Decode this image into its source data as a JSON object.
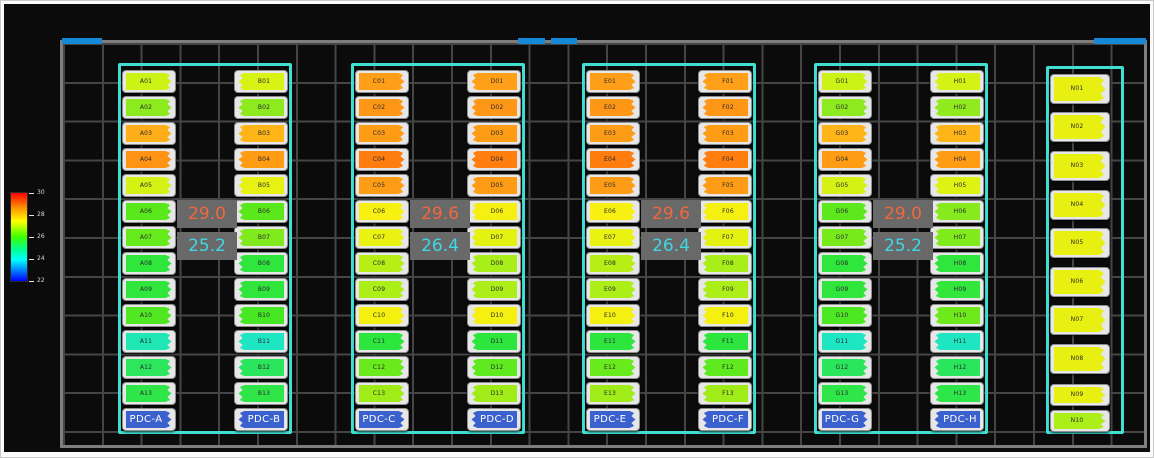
{
  "colors": {
    "canvas_bg": "#0b0b0b",
    "wall": "#7e7e7e",
    "grid_line": "#454545",
    "door_blue": "#1689d6",
    "containment_outline": "#40dfd2",
    "temp_box_bg": "#696969",
    "temp_hot_text": "#f2683c",
    "temp_cold_text": "#40d6e6",
    "pdc_fill": "#3a61ce",
    "rack_shell": "#e7e7e7"
  },
  "legend": {
    "ticks": [
      "30",
      "28",
      "26",
      "24",
      "22"
    ]
  },
  "doors": [
    {
      "x": 62,
      "w": 40
    },
    {
      "x": 518,
      "w": 27
    },
    {
      "x": 551,
      "w": 26
    },
    {
      "x": 1094,
      "w": 52
    }
  ],
  "groups": [
    {
      "x": 118,
      "temp_hot": "29.0",
      "temp_cold": "25.2",
      "columns": [
        {
          "facing": "right",
          "pdc": "PDC-A",
          "racks": [
            [
              "A01",
              "#ccf216"
            ],
            [
              "A02",
              "#8cea1e"
            ],
            [
              "A03",
              "#ffae1a"
            ],
            [
              "A04",
              "#ff9414"
            ],
            [
              "A05",
              "#d6f214"
            ],
            [
              "A06",
              "#58e81c"
            ],
            [
              "A07",
              "#66ea1c"
            ],
            [
              "A08",
              "#2ee63c"
            ],
            [
              "A09",
              "#30e63c"
            ],
            [
              "A10",
              "#50e822"
            ],
            [
              "A11",
              "#20e6b4"
            ],
            [
              "A12",
              "#2ce65e"
            ],
            [
              "A13",
              "#2ee648"
            ]
          ]
        },
        {
          "facing": "left",
          "pdc": "PDC-B",
          "racks": [
            [
              "B01",
              "#d8f214"
            ],
            [
              "B02",
              "#8cea1e"
            ],
            [
              "B03",
              "#ffb418"
            ],
            [
              "B04",
              "#ff9c14"
            ],
            [
              "B05",
              "#e8f212"
            ],
            [
              "B06",
              "#5ae81c"
            ],
            [
              "B07",
              "#80ea1c"
            ],
            [
              "B08",
              "#2ee63c"
            ],
            [
              "B09",
              "#30e63c"
            ],
            [
              "B10",
              "#46e824"
            ],
            [
              "B11",
              "#1ee6c2"
            ],
            [
              "B12",
              "#2ae65c"
            ],
            [
              "B13",
              "#2ee648"
            ]
          ]
        }
      ]
    },
    {
      "x": 351,
      "temp_hot": "29.6",
      "temp_cold": "26.4",
      "columns": [
        {
          "facing": "right",
          "pdc": "PDC-C",
          "racks": [
            [
              "C01",
              "#ff9e18"
            ],
            [
              "C02",
              "#ff9616"
            ],
            [
              "C03",
              "#ff9c16"
            ],
            [
              "C04",
              "#ff7c0e"
            ],
            [
              "C05",
              "#ff9c16"
            ],
            [
              "C06",
              "#f8f010"
            ],
            [
              "C07",
              "#eaf212"
            ],
            [
              "C08",
              "#b6ee16"
            ],
            [
              "C09",
              "#acee18"
            ],
            [
              "C10",
              "#f4f010"
            ],
            [
              "C11",
              "#2ce63e"
            ],
            [
              "C12",
              "#68ea1c"
            ],
            [
              "C13",
              "#a0ec18"
            ]
          ]
        },
        {
          "facing": "left",
          "pdc": "PDC-D",
          "racks": [
            [
              "D01",
              "#ffa018"
            ],
            [
              "D02",
              "#ff9616"
            ],
            [
              "D03",
              "#ff9c16"
            ],
            [
              "D04",
              "#ff7e0e"
            ],
            [
              "D05",
              "#ff9c16"
            ],
            [
              "D06",
              "#f6f010"
            ],
            [
              "D07",
              "#e4f212"
            ],
            [
              "D08",
              "#a8ee18"
            ],
            [
              "D09",
              "#acee18"
            ],
            [
              "D10",
              "#f4f010"
            ],
            [
              "D11",
              "#2ce63e"
            ],
            [
              "D12",
              "#5eea1e"
            ],
            [
              "D13",
              "#a0ec18"
            ]
          ]
        }
      ]
    },
    {
      "x": 582,
      "temp_hot": "29.6",
      "temp_cold": "26.4",
      "columns": [
        {
          "facing": "right",
          "pdc": "PDC-E",
          "racks": [
            [
              "E01",
              "#ff9e18"
            ],
            [
              "E02",
              "#ff9616"
            ],
            [
              "E03",
              "#ff9c16"
            ],
            [
              "E04",
              "#ff7c0e"
            ],
            [
              "E05",
              "#ff9c16"
            ],
            [
              "E06",
              "#f8f010"
            ],
            [
              "E07",
              "#eaf212"
            ],
            [
              "E08",
              "#b6ee16"
            ],
            [
              "E09",
              "#acee18"
            ],
            [
              "E10",
              "#f4f010"
            ],
            [
              "E11",
              "#2ce63e"
            ],
            [
              "E12",
              "#68ea1c"
            ],
            [
              "E13",
              "#a0ec18"
            ]
          ]
        },
        {
          "facing": "left",
          "pdc": "PDC-F",
          "racks": [
            [
              "F01",
              "#ffa018"
            ],
            [
              "F02",
              "#ff9616"
            ],
            [
              "F03",
              "#ff9c16"
            ],
            [
              "F04",
              "#ff7e0e"
            ],
            [
              "F05",
              "#ff9c16"
            ],
            [
              "F06",
              "#f6f010"
            ],
            [
              "F07",
              "#e4f212"
            ],
            [
              "F08",
              "#a8ee18"
            ],
            [
              "F09",
              "#acee18"
            ],
            [
              "F10",
              "#f4f010"
            ],
            [
              "F11",
              "#2ce63e"
            ],
            [
              "F12",
              "#5eea1e"
            ],
            [
              "F13",
              "#a0ec18"
            ]
          ]
        }
      ]
    },
    {
      "x": 814,
      "temp_hot": "29.0",
      "temp_cold": "25.2",
      "columns": [
        {
          "facing": "right",
          "pdc": "PDC-G",
          "racks": [
            [
              "G01",
              "#ccf216"
            ],
            [
              "G02",
              "#8cea1e"
            ],
            [
              "G03",
              "#ffb418"
            ],
            [
              "G04",
              "#ff9c14"
            ],
            [
              "G05",
              "#d6f214"
            ],
            [
              "G06",
              "#5ce81c"
            ],
            [
              "G07",
              "#78ea1c"
            ],
            [
              "G08",
              "#2ee63c"
            ],
            [
              "G09",
              "#30e63c"
            ],
            [
              "G10",
              "#4ce822"
            ],
            [
              "G11",
              "#1ee6c2"
            ],
            [
              "G12",
              "#2ae65c"
            ],
            [
              "G13",
              "#2ee648"
            ]
          ]
        },
        {
          "facing": "left",
          "pdc": "PDC-H",
          "racks": [
            [
              "H01",
              "#d4f214"
            ],
            [
              "H02",
              "#90ea1e"
            ],
            [
              "H03",
              "#ffb418"
            ],
            [
              "H04",
              "#ff9c14"
            ],
            [
              "H05",
              "#def213"
            ],
            [
              "H06",
              "#86ea1c"
            ],
            [
              "H07",
              "#80ea1c"
            ],
            [
              "H08",
              "#2ee63c"
            ],
            [
              "H09",
              "#32e63c"
            ],
            [
              "H10",
              "#6eea1c"
            ],
            [
              "H11",
              "#1ee6c2"
            ],
            [
              "H12",
              "#2ae65c"
            ],
            [
              "H13",
              "#2ee648"
            ]
          ]
        }
      ]
    }
  ],
  "n_column": {
    "x": 1046,
    "shell_x": 1050,
    "facing": "right",
    "racks": [
      [
        "N01",
        "#e8f012",
        74,
        30
      ],
      [
        "N02",
        "#e8f012",
        112,
        30
      ],
      [
        "N03",
        "#e8f012",
        151,
        30
      ],
      [
        "N04",
        "#e8f012",
        190,
        30
      ],
      [
        "N05",
        "#e8f012",
        228,
        30
      ],
      [
        "N06",
        "#e8f012",
        267,
        30
      ],
      [
        "N07",
        "#e8f012",
        305,
        30
      ],
      [
        "N08",
        "#e8f012",
        344,
        30
      ],
      [
        "N09",
        "#e8f012",
        384,
        22
      ],
      [
        "N10",
        "#acee18",
        410,
        22
      ]
    ]
  }
}
